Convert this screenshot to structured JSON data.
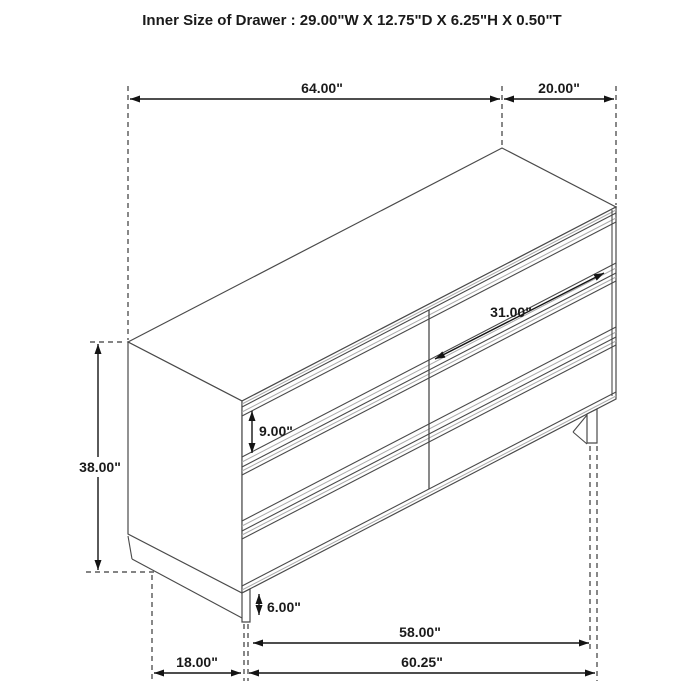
{
  "title": "Inner Size of Drawer : 29.00\"W X 12.75\"D X 6.25\"H X 0.50\"T",
  "dimensions": {
    "overall_width": "64.00\"",
    "overall_depth": "20.00\"",
    "overall_height": "38.00\"",
    "drawer_width": "31.00\"",
    "drawer_height": "9.00\"",
    "leg_height": "6.00\"",
    "front_span": "58.00\"",
    "base_width": "60.25\"",
    "base_depth": "18.00\""
  },
  "colors": {
    "background": "#ffffff",
    "figure_line": "#4a4a4a",
    "dimension_line": "#141414",
    "accent_gray": "#ababab",
    "text": "#1a1a1a"
  }
}
